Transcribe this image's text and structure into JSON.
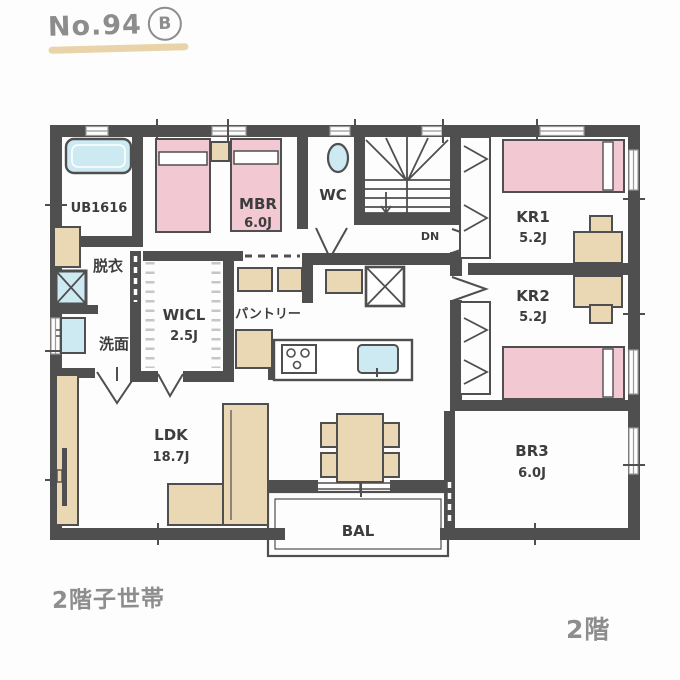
{
  "header": {
    "plan_number": "No.94",
    "plan_variant": "B"
  },
  "captions": {
    "bottom_left": "2階子世帯",
    "bottom_right": "2階"
  },
  "rooms": {
    "ub": {
      "label": "UB1616"
    },
    "datsui": {
      "label": "脱衣"
    },
    "senmen": {
      "label": "洗面"
    },
    "mbr": {
      "label": "MBR",
      "size": "6.0J"
    },
    "wc": {
      "label": "WC"
    },
    "stairs": {
      "label": "DN"
    },
    "wicl": {
      "label": "WICL",
      "size": "2.5J"
    },
    "pantry": {
      "label": "パントリー"
    },
    "kr1": {
      "label": "KR1",
      "size": "5.2J"
    },
    "kr2": {
      "label": "KR2",
      "size": "5.2J"
    },
    "ldk": {
      "label": "LDK",
      "size": "18.7J"
    },
    "bal": {
      "label": "BAL"
    },
    "br3": {
      "label": "BR3",
      "size": "6.0J"
    }
  },
  "colors": {
    "wall": "#4f4f4f",
    "bed_pink": "#f2c8d3",
    "furniture_beige": "#ead7b4",
    "fixture_blue": "#cdeaf3",
    "paper": "#fdfdfd",
    "hand_text": "#8d8d8d",
    "label_text": "#3d3d3d",
    "title_underline": "#e9d4a9"
  }
}
